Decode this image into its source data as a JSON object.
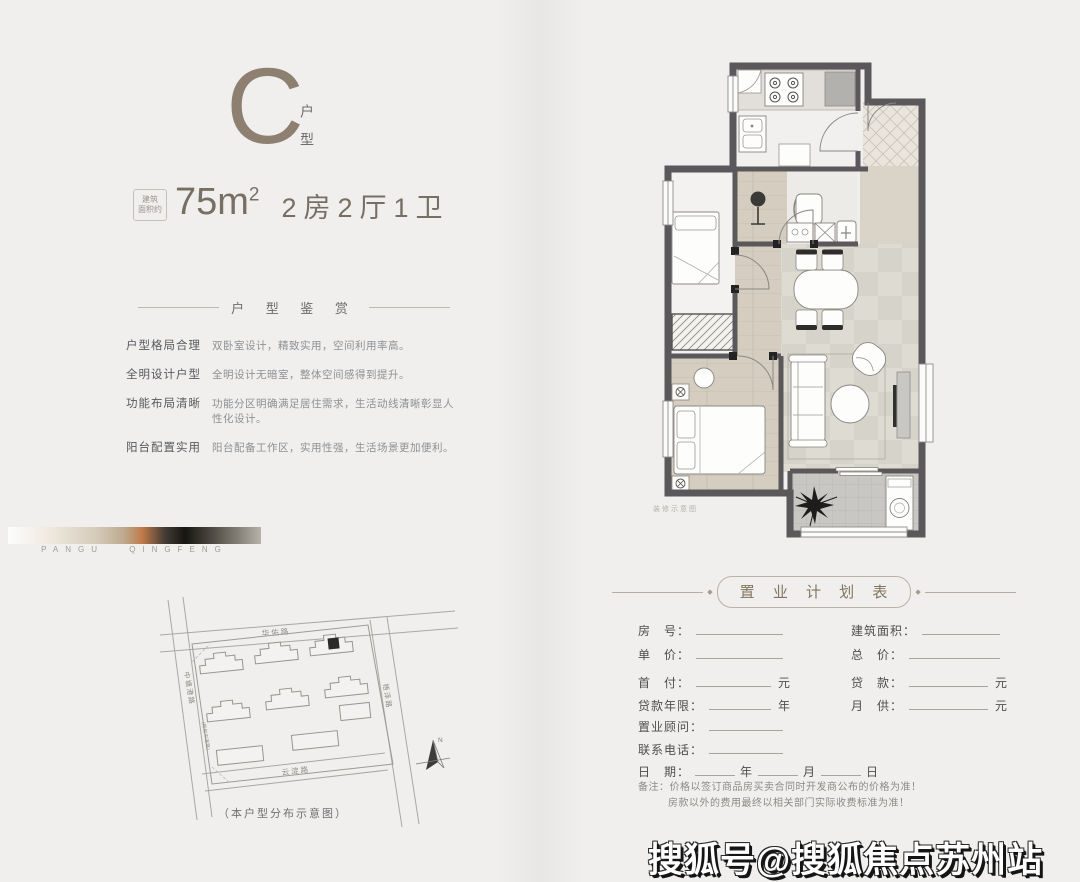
{
  "unit": {
    "letter": "C",
    "type_label": "户型",
    "area_box_line1": "建筑",
    "area_box_line2": "面积约",
    "area_value": "75m",
    "area_sup": "2",
    "rooms": "2房2厅1卫"
  },
  "appreciation": {
    "title": "户 型 鉴 赏",
    "items": [
      {
        "label": "户型格局合理",
        "desc": "双卧室设计，精致实用，空间利用率高。"
      },
      {
        "label": "全明设计户型",
        "desc": "全明设计无暗室，整体空间感得到提升。"
      },
      {
        "label": "功能布局清晰",
        "desc": "功能分区明确满足居住需求，生活动线清晰彰显人性化设计。"
      },
      {
        "label": "阳台配置实用",
        "desc": "阳台配备工作区，实用性强，生活场景更加便利。"
      }
    ]
  },
  "brand_strip": {
    "text": "PANGU QINGFENG"
  },
  "site_map": {
    "road_top": "华佑路",
    "road_left": "中塘港路",
    "road_left_note": "(规划中道路)",
    "road_right": "梧泽路",
    "road_bottom": "云淀路",
    "north": "N",
    "caption": "（本户型分布示意图）"
  },
  "floor_plan": {
    "caption": "装修示意图"
  },
  "plan_form": {
    "title": "置 业 计 划 表",
    "side_dot": "◆",
    "left_rows": [
      {
        "label": "房　号：",
        "suffix": ""
      },
      {
        "label": "单　价：",
        "suffix": ""
      },
      {
        "label": "首　付：",
        "suffix": "元"
      },
      {
        "label": "贷款年限：",
        "suffix": "年"
      },
      {
        "label": "置业顾问：",
        "suffix": ""
      },
      {
        "label": "联系电话：",
        "suffix": ""
      }
    ],
    "right_rows": [
      {
        "label": "建筑面积：",
        "suffix": ""
      },
      {
        "label": "总　价：",
        "suffix": ""
      },
      {
        "label": "贷　款：",
        "suffix": "元"
      },
      {
        "label": "月　供：",
        "suffix": "元"
      }
    ],
    "date_row": {
      "label": "日　期：",
      "y": "年",
      "m": "月",
      "d": "日"
    },
    "notes": [
      "备注：价格以签订商品房买卖合同时开发商公布的价格为准！",
      "房款以外的费用最终以相关部门实际收费标准为准！"
    ]
  },
  "watermark": {
    "text": "搜狐号@搜狐焦点苏州站"
  },
  "colors": {
    "accent": "#8d8071",
    "wall": "#5a585a",
    "page_bg": "#f0efed"
  }
}
